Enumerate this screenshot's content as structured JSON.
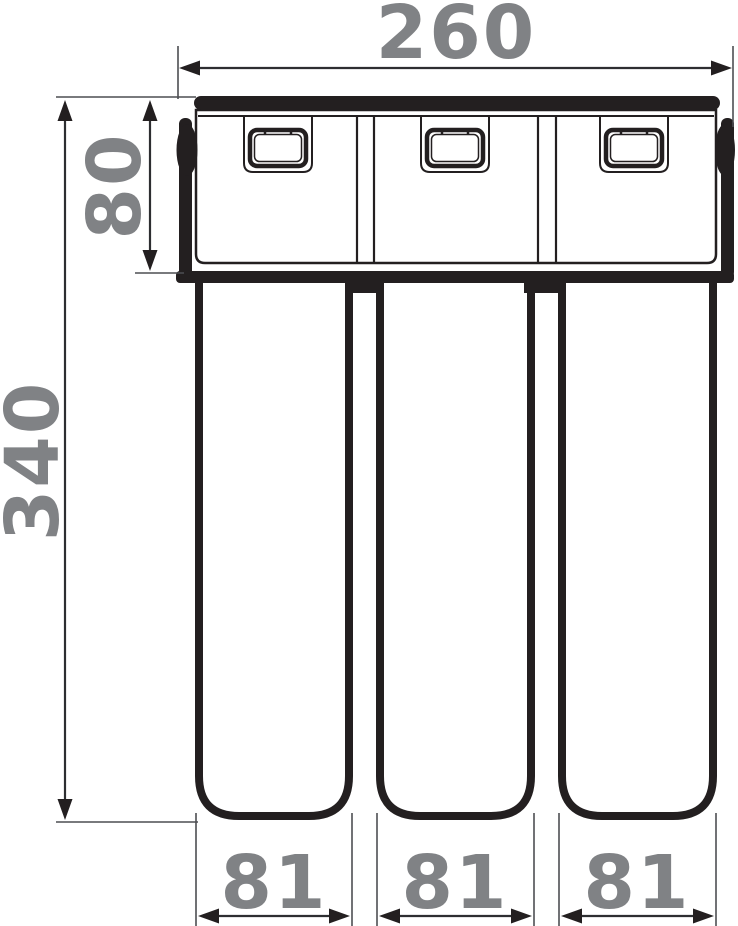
{
  "diagram": {
    "kind": "technical-drawing",
    "colors": {
      "line": "#231f20",
      "dimension_line": "#2d2e31",
      "extension_line": "#4d4e52",
      "dimension_text": "#808285",
      "background": "#ffffff"
    },
    "dims": {
      "overall_width": "260",
      "head_height": "80",
      "overall_height": "340",
      "cartridge_widths": [
        "81",
        "81",
        "81"
      ]
    }
  }
}
